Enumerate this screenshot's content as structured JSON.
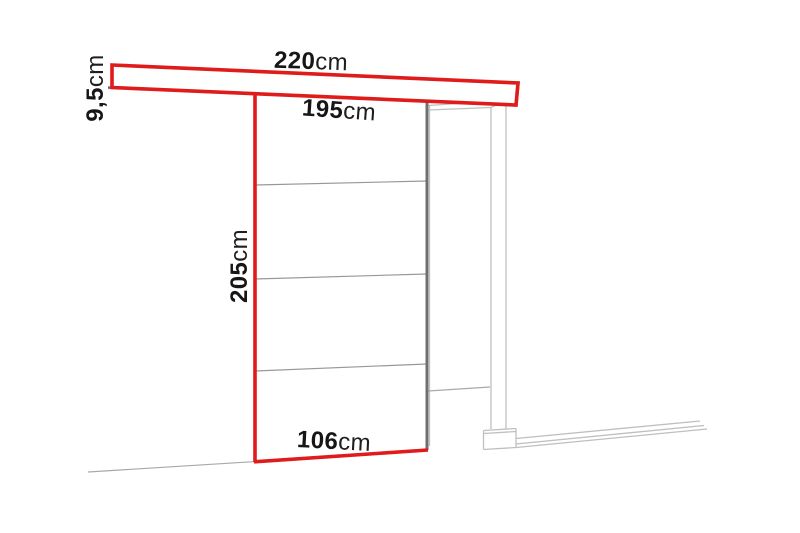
{
  "diagram": {
    "name": "sliding-door-system-dimension-diagram",
    "unit": "cm",
    "labels": {
      "track_length": {
        "value": "220",
        "unit": "cm"
      },
      "track_height": {
        "value": "9,5",
        "unit": "cm"
      },
      "upper_width": {
        "value": "195",
        "unit": "cm"
      },
      "door_height": {
        "value": "205",
        "unit": "cm"
      },
      "door_bottom_width": {
        "value": "106",
        "unit": "cm"
      }
    },
    "colors": {
      "accent_red": "#e01b1b",
      "door_edge_gray": "#6f6f6f",
      "divider_gray": "#8d8d8d",
      "frame_gray": "#bfbfbf",
      "floor_gray": "#a9a9a9",
      "text": "#161616",
      "background": "#ffffff"
    }
  }
}
